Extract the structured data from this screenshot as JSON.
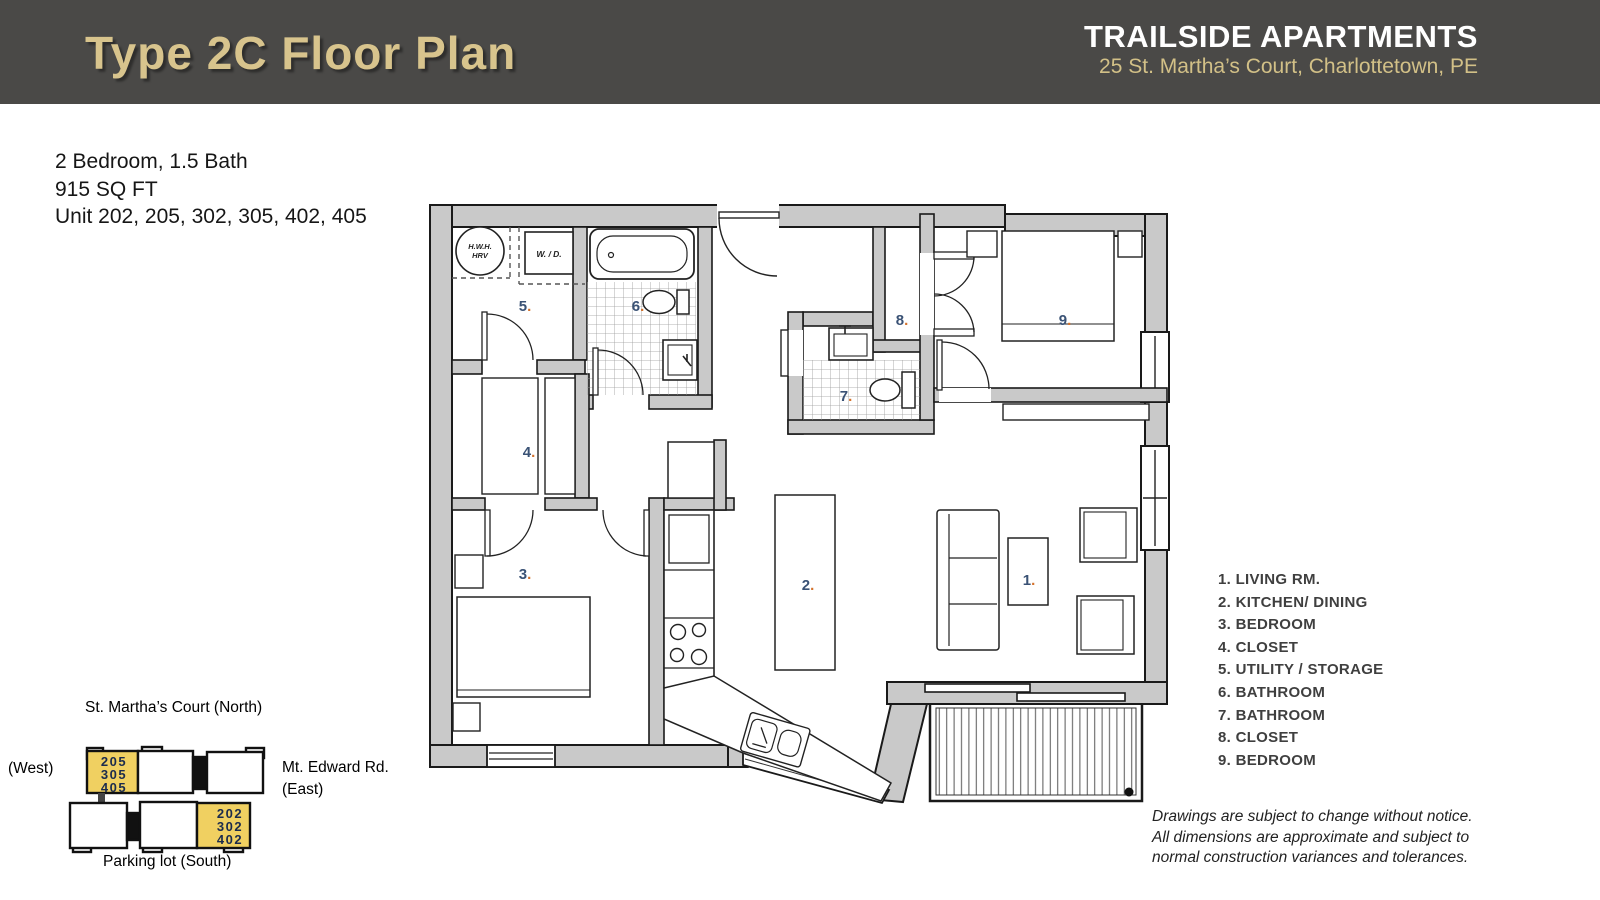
{
  "header": {
    "title": "Type 2C Floor Plan",
    "brand": "TRAILSIDE APARTMENTS",
    "address": "25 St. Martha’s Court, Charlottetown, PE"
  },
  "info": {
    "line1": "2 Bedroom, 1.5 Bath",
    "line2": "915 SQ FT",
    "line3": "Unit 202, 205, 302, 305, 402, 405"
  },
  "legend": {
    "items": [
      "1. LIVING RM.",
      "2. KITCHEN/ DINING",
      "3. BEDROOM",
      "4. CLOSET",
      "5. UTILITY / STORAGE",
      "6. BATHROOM",
      "7. BATHROOM",
      "8. CLOSET",
      "9. BEDROOM"
    ]
  },
  "plan": {
    "rooms": {
      "r1": "1",
      "r2": "2",
      "r3": "3",
      "r4": "4",
      "r5": "5",
      "r6": "6",
      "r7": "7",
      "r8": "8",
      "r9": "9"
    },
    "dot": ".",
    "utility": {
      "hwh1": "H.W.H.",
      "hwh2": "HRV",
      "wd": "W. / D."
    }
  },
  "site_map": {
    "north": "St. Martha’s Court (North)",
    "west": "(West)",
    "east1": "Mt. Edward Rd.",
    "east2": "(East)",
    "south": "Parking lot (South)",
    "units_west": [
      "205",
      "305",
      "405"
    ],
    "units_east": [
      "202",
      "302",
      "402"
    ]
  },
  "disclaimer": {
    "line1": "Drawings are subject to change without notice.",
    "line2": "All dimensions are approximate and subject to",
    "line3": "normal construction variances and tolerances."
  },
  "colors": {
    "header_bg": "#4a4947",
    "title_gold": "#d8c48d",
    "brand_white": "#ffffff",
    "wall_gray": "#c9c9c9",
    "highlight_yellow": "#f0d061",
    "room_number_blue": "#3a5275",
    "room_dot_orange": "#d4722c"
  }
}
